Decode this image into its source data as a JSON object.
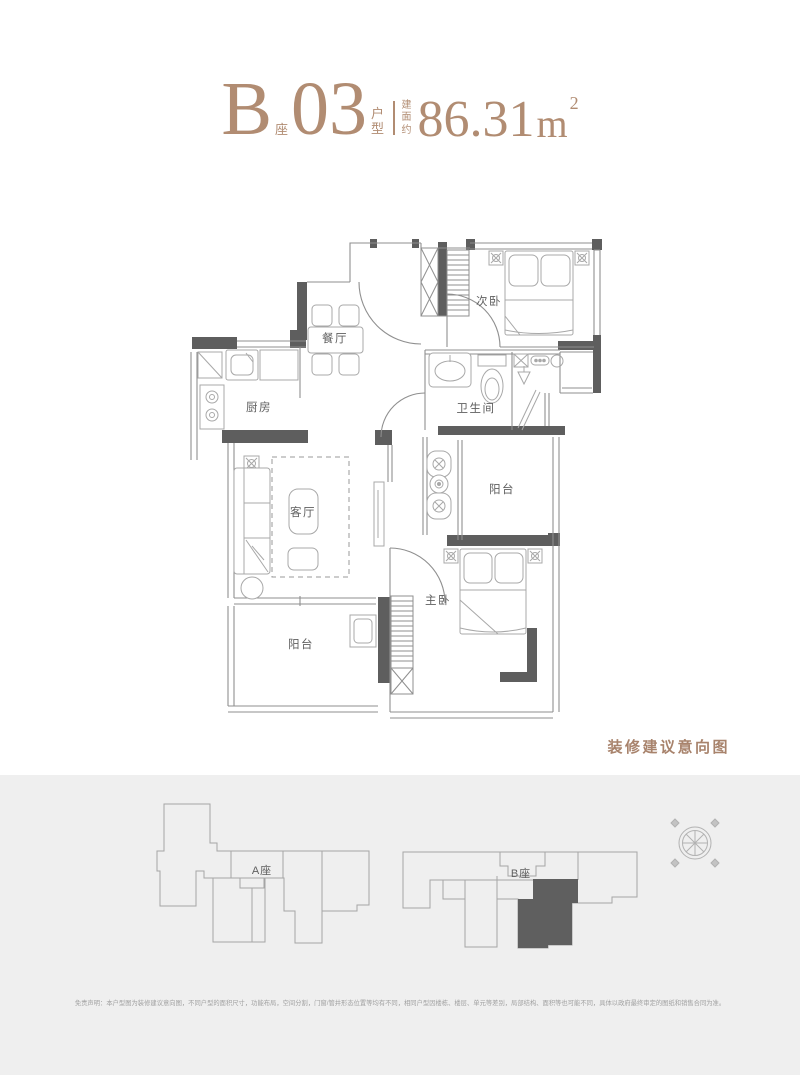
{
  "title": {
    "block": "B",
    "block_suffix": "座",
    "unit": "03",
    "unit_suffix": "户型",
    "area_prefix": "建面约",
    "area_value": "86.31",
    "area_unit": "m",
    "area_exp": "2"
  },
  "floorplan": {
    "caption": "装修建议意向图",
    "rooms": {
      "second_bedroom": "次卧",
      "dining": "餐厅",
      "kitchen": "厨房",
      "bathroom": "卫生间",
      "balcony_east": "阳台",
      "living": "客厅",
      "master_bedroom": "主卧",
      "balcony_south": "阳台"
    }
  },
  "site": {
    "building_a": "A座",
    "building_b": "B座",
    "highlighted_unit": "B座03",
    "disclaimer": "免责声明：本户型图为装修建议意向图，不同户型的面积尺寸，功能布局，空间分割，门窗/管井形态位置等均有不同，相同户型因楼栋、楼层、单元等差别，局部结构、面积等也可能不同，具体以政府最终审定的图纸和销售合同为准。"
  },
  "icons": {
    "compass": "compass-rose"
  },
  "colors": {
    "accent": "#b18c72",
    "wall_dark": "#5e5e5e",
    "wall_line": "#8f8f8f",
    "band_bg": "#efefef",
    "unit_fill": "#5f5f5f"
  }
}
